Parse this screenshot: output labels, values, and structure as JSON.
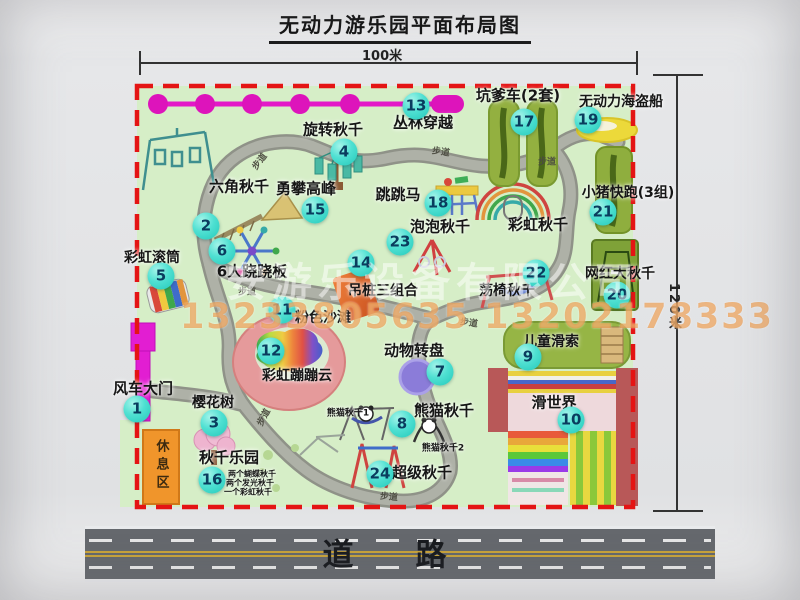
{
  "title": "无动力游乐园平面布局图",
  "dimensions": {
    "width": "100米",
    "height": "120米"
  },
  "road": {
    "label": "道路"
  },
  "watermark": {
    "company": "安游乐设备有限公司",
    "phone": "13233805635 13202178333"
  },
  "map": {
    "badge_color": "#2fd3c4",
    "border_color": "#e41414",
    "ground_color": "#d6eec7",
    "badges": [
      {
        "n": "1",
        "x": 137,
        "y": 409
      },
      {
        "n": "2",
        "x": 206,
        "y": 226
      },
      {
        "n": "3",
        "x": 214,
        "y": 423
      },
      {
        "n": "4",
        "x": 344,
        "y": 152
      },
      {
        "n": "5",
        "x": 161,
        "y": 276
      },
      {
        "n": "6",
        "x": 222,
        "y": 251
      },
      {
        "n": "7",
        "x": 440,
        "y": 372
      },
      {
        "n": "8",
        "x": 402,
        "y": 424
      },
      {
        "n": "9",
        "x": 528,
        "y": 357
      },
      {
        "n": "10",
        "x": 571,
        "y": 420
      },
      {
        "n": "11",
        "x": 282,
        "y": 310
      },
      {
        "n": "12",
        "x": 271,
        "y": 351
      },
      {
        "n": "13",
        "x": 416,
        "y": 106
      },
      {
        "n": "14",
        "x": 361,
        "y": 263
      },
      {
        "n": "15",
        "x": 315,
        "y": 210
      },
      {
        "n": "16",
        "x": 212,
        "y": 480
      },
      {
        "n": "17",
        "x": 524,
        "y": 122
      },
      {
        "n": "18",
        "x": 438,
        "y": 203
      },
      {
        "n": "19",
        "x": 588,
        "y": 120
      },
      {
        "n": "20",
        "x": 617,
        "y": 295
      },
      {
        "n": "21",
        "x": 603,
        "y": 212
      },
      {
        "n": "22",
        "x": 536,
        "y": 273
      },
      {
        "n": "23",
        "x": 400,
        "y": 242
      },
      {
        "n": "24",
        "x": 380,
        "y": 474
      }
    ],
    "labels": [
      {
        "t": "风车大门",
        "x": 143,
        "y": 388,
        "s": 15
      },
      {
        "t": "六角秋千",
        "x": 239,
        "y": 186,
        "s": 15
      },
      {
        "t": "旋转秋千",
        "x": 333,
        "y": 129,
        "s": 15
      },
      {
        "t": "勇攀高峰",
        "x": 306,
        "y": 188,
        "s": 15
      },
      {
        "t": "丛林穿越",
        "x": 423,
        "y": 122,
        "s": 15
      },
      {
        "t": "坑爹车(2套)",
        "x": 518,
        "y": 95,
        "s": 15
      },
      {
        "t": "无动力海盗船",
        "x": 621,
        "y": 101,
        "s": 14
      },
      {
        "t": "小猪快跑(3组)",
        "x": 628,
        "y": 192,
        "s": 14
      },
      {
        "t": "跳跳马",
        "x": 398,
        "y": 194,
        "s": 15
      },
      {
        "t": "泡泡秋千",
        "x": 440,
        "y": 226,
        "s": 15
      },
      {
        "t": "彩虹秋千",
        "x": 538,
        "y": 224,
        "s": 15
      },
      {
        "t": "彩虹滚筒",
        "x": 152,
        "y": 257,
        "s": 14
      },
      {
        "t": "6人跷跷板",
        "x": 252,
        "y": 271,
        "s": 15
      },
      {
        "t": "吊桩三组合",
        "x": 383,
        "y": 290,
        "s": 14
      },
      {
        "t": "荡椅秋千",
        "x": 507,
        "y": 290,
        "s": 14
      },
      {
        "t": "网红大秋千",
        "x": 620,
        "y": 273,
        "s": 14
      },
      {
        "t": "粉色沙滩",
        "x": 323,
        "y": 317,
        "s": 14
      },
      {
        "t": "儿童滑索",
        "x": 551,
        "y": 341,
        "s": 14
      },
      {
        "t": "动物转盘",
        "x": 414,
        "y": 350,
        "s": 15
      },
      {
        "t": "彩虹蹦蹦云",
        "x": 297,
        "y": 375,
        "s": 14
      },
      {
        "t": "滑世界",
        "x": 554,
        "y": 402,
        "s": 15
      },
      {
        "t": "熊猫秋千",
        "x": 444,
        "y": 410,
        "s": 15
      },
      {
        "t": "樱花树",
        "x": 213,
        "y": 402,
        "s": 14
      },
      {
        "t": "熊猫秋千1",
        "x": 348,
        "y": 412,
        "s": 9
      },
      {
        "t": "熊猫秋千2",
        "x": 443,
        "y": 447,
        "s": 9
      },
      {
        "t": "超级秋千",
        "x": 422,
        "y": 472,
        "s": 15
      },
      {
        "t": "秋千乐园",
        "x": 229,
        "y": 457,
        "s": 15
      },
      {
        "t": "两个蝴蝶秋千",
        "x": 252,
        "y": 474,
        "s": 8
      },
      {
        "t": "两个发光秋千",
        "x": 250,
        "y": 483,
        "s": 8
      },
      {
        "t": "一个彩虹秋千",
        "x": 248,
        "y": 492,
        "s": 8
      },
      {
        "t": "休息区",
        "x": 161,
        "y": 466,
        "s": 13,
        "v": 1
      }
    ],
    "path_labels": [
      {
        "t": "步道",
        "x": 259,
        "y": 161,
        "r": -52
      },
      {
        "t": "步道",
        "x": 441,
        "y": 151,
        "r": 8
      },
      {
        "t": "步道",
        "x": 547,
        "y": 161,
        "r": 0
      },
      {
        "t": "步道",
        "x": 247,
        "y": 291,
        "r": 0
      },
      {
        "t": "步道",
        "x": 469,
        "y": 322,
        "r": 8
      },
      {
        "t": "步道",
        "x": 263,
        "y": 417,
        "r": -62
      },
      {
        "t": "步道",
        "x": 389,
        "y": 496,
        "r": 5
      }
    ]
  }
}
